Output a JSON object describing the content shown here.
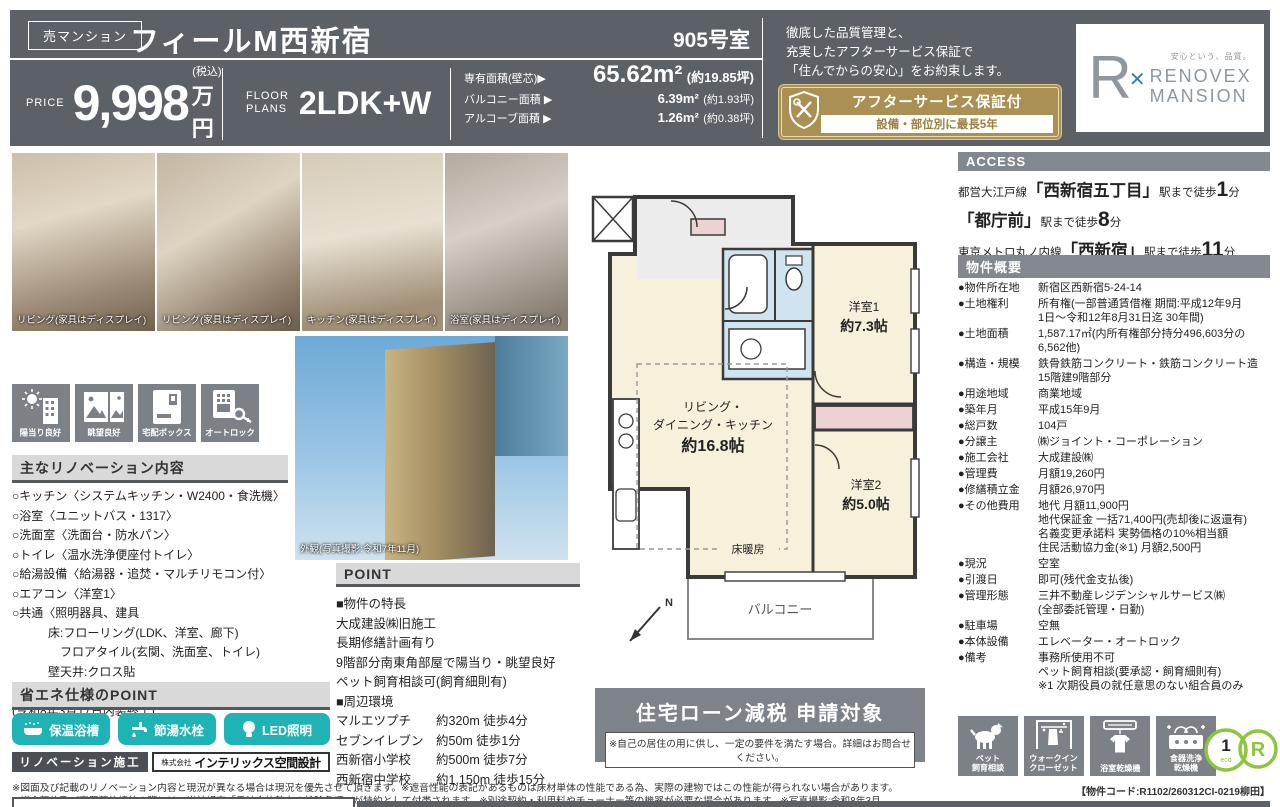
{
  "header": {
    "sale_badge": "売マンション",
    "title": "フィールM西新宿",
    "room_number": "905号室",
    "price_label": "PRICE",
    "price_value": "9,998",
    "price_tax_note": "(税込)",
    "price_unit": "万円",
    "floor_plans_label_1": "FLOOR",
    "floor_plans_label_2": "PLANS",
    "floor_plans_value": "2LDK+W",
    "area_rows": [
      {
        "label": "専有面積(壁芯)▶",
        "value": "65.62m²",
        "tsubo": "(約19.85坪)"
      },
      {
        "label": "バルコニー面積 ▶",
        "value": "6.39m²",
        "tsubo": "(約1.93坪)"
      },
      {
        "label": "アルコーブ面積 ▶",
        "value": "1.26m²",
        "tsubo": "(約0.38坪)"
      }
    ],
    "quality_line_1": "徹底した品質管理と、",
    "quality_line_2": "充実したアフターサービス保証で",
    "quality_line_3": "「住んでからの安心」をお約束します。",
    "warranty_badge_title": "アフターサービス保証付",
    "warranty_badge_sub": "設備・部位別に最長5年",
    "logo_mark": "R",
    "logo_mark_x": "✕",
    "logo_tagline": "安心という、品質。",
    "logo_name_line1": "RENOVEX",
    "logo_name_line2": "MANSION"
  },
  "photos": {
    "captions": [
      "リビング(家具はディスプレイ)",
      "リビング(家具はディスプレイ)",
      "キッチン(家具はディスプレイ)",
      "浴室(家具はディスプレイ)"
    ],
    "exterior_caption": "外観(写真撮影:令和7年11月)"
  },
  "feature_badges": [
    "陽当り良好",
    "眺望良好",
    "宅配ボックス",
    "オートロック"
  ],
  "renovation": {
    "heading": "主なリノベーション内容",
    "items": [
      "○キッチン〈システムキッチン・W2400・食洗機〉",
      "○浴室〈ユニットバス・1317〉",
      "○洗面室〈洗面台・防水パン〉",
      "○トイレ〈温水洗浄便座付トイレ〉",
      "○給湯設備〈給湯器・追焚・マルチリモコン付〉",
      "○エアコン〈洋室1〉",
      "○共通〈照明器具、建具\n　　　床:フローリング(LDK、洋室、廊下)\n　　　　フロアタイル(玄関、洗面室、トイレ)\n　　　壁天井:クロス貼\n　　　床暖房(LD)、室内クリーニング〉",
      "(令和8年3月17日内装終了)"
    ]
  },
  "eco_spec": {
    "heading": "省エネ仕様のPOINT",
    "buttons": [
      "保温浴槽",
      "節湯水栓",
      "LED照明"
    ]
  },
  "builder": {
    "label": "リノベーション施工",
    "company_prefix": "株式会社",
    "company_name": "インテリックス空間設計"
  },
  "floor_plan": {
    "room1_name": "洋室1",
    "room1_size": "約7.3帖",
    "ldk_line1": "リビング・",
    "ldk_line2": "ダイニング・キッチン",
    "ldk_size": "約16.8帖",
    "room2_name": "洋室2",
    "room2_size": "約5.0帖",
    "floor_heating": "床暖房",
    "balcony": "バルコニー",
    "north": "N"
  },
  "point": {
    "heading": "POINT",
    "lines": [
      "■物件の特長",
      "大成建設㈱旧施工",
      "長期修繕計画有り",
      "9階部分南東角部屋で陽当り・眺望良好",
      "ペット飼育相談可(飼育細則有)",
      "■周辺環境",
      "マルエツプチ　　約320m 徒歩4分",
      "セブンイレブン　約50m 徒歩1分",
      "西新宿小学校　　約500m 徒歩7分",
      "西新宿中学校　　約1,150m 徒歩15分"
    ]
  },
  "loan_box": {
    "title": "住宅ローン減税 申請対象",
    "note": "※自己の居住の用に供し、一定の要件を満たす場合。詳細はお問合せください。"
  },
  "access": {
    "heading": "ACCESS",
    "routes": [
      {
        "line": "都営大江戸線",
        "station": "「西新宿五丁目」",
        "mid": "駅まで徒歩",
        "minutes": "1",
        "unit": "分"
      },
      {
        "line": "",
        "station": "「都庁前」",
        "mid": "駅まで徒歩",
        "minutes": "8",
        "unit": "分"
      },
      {
        "line": "東京メトロ丸ノ内線",
        "station": "「西新宿」",
        "mid": "駅まで徒歩",
        "minutes": "11",
        "unit": "分"
      }
    ]
  },
  "overview": {
    "heading": "物件概要",
    "rows": [
      {
        "label": "●物件所在地",
        "value": "新宿区西新宿5-24-14"
      },
      {
        "label": "●土地権利",
        "value": "所有権(一部普通賃借権 期間:平成12年9月\n1日〜令和12年8月31日迄 30年間)"
      },
      {
        "label": "●土地面積",
        "value": "1,587.17㎡(内所有権部分持分496,603分の\n6,562他)"
      },
      {
        "label": "●構造・規模",
        "value": "鉄骨鉄筋コンクリート・鉄筋コンクリート造\n15階建9階部分"
      },
      {
        "label": "●用途地域",
        "value": "商業地域"
      },
      {
        "label": "●築年月",
        "value": "平成15年9月"
      },
      {
        "label": "●総戸数",
        "value": "104戸"
      },
      {
        "label": "●分譲主",
        "value": "㈱ジョイント・コーポレーション"
      },
      {
        "label": "●施工会社",
        "value": "大成建設㈱"
      },
      {
        "label": "●管理費",
        "value": "月額19,260円"
      },
      {
        "label": "●修繕積立金",
        "value": "月額26,970円"
      },
      {
        "label": "●その他費用",
        "value": "地代 月額11,900円\n地代保証金 一括71,400円(売却後に返還有)\n名義変更承諾料 実勢価格の10%相当額\n住民活動協力金(※1) 月額2,500円"
      },
      {
        "label": "●現況",
        "value": "空室"
      },
      {
        "label": "●引渡日",
        "value": "即可(残代金支払後)"
      },
      {
        "label": "●管理形態",
        "value": "三井不動産レジデンシャルサービス㈱\n(全部委託管理・日勤)"
      },
      {
        "label": "●駐車場",
        "value": "空無"
      },
      {
        "label": "●本体設備",
        "value": "エレベーター・オートロック"
      },
      {
        "label": "●備考",
        "value": "事務所使用不可\nペット飼育相談(要承認・飼育細則有)\n※1 次期役員の就任意思のない組合員のみ"
      }
    ]
  },
  "amenity_badges": [
    "ペット\n飼育相談",
    "ウォークイン\nクローゼット",
    "浴室乾燥機",
    "食器洗浄\n乾燥機"
  ],
  "eco_marks": {
    "mark1_top": "1",
    "mark1_bottom": "eco",
    "mark2": "R"
  },
  "property_code": "【物件コード:R1102/260312CI-0219柳田】",
  "footer": {
    "line1": "※図面及び記載のリノベーション内容と現況が異なる場合は現況を優先させて頂きます。※遮音性能の表記があるものは床材単体の性能である為、実際の建物ではこの性能が得られない場合があります。",
    "line2": "※媒介契約及び売買契約締結の際には、当社規定「反社会的勢力の排除条項」が特約として付帯されます。※別途契約・利用料やチューナー等の機器が必要な場合があります。※写真撮影:令和8年3月"
  },
  "colors": {
    "header_bg": "#5c6167",
    "accent_teal": "#1fb3b5",
    "gold": "#aa9052",
    "eco_green": "#8cc63e"
  }
}
